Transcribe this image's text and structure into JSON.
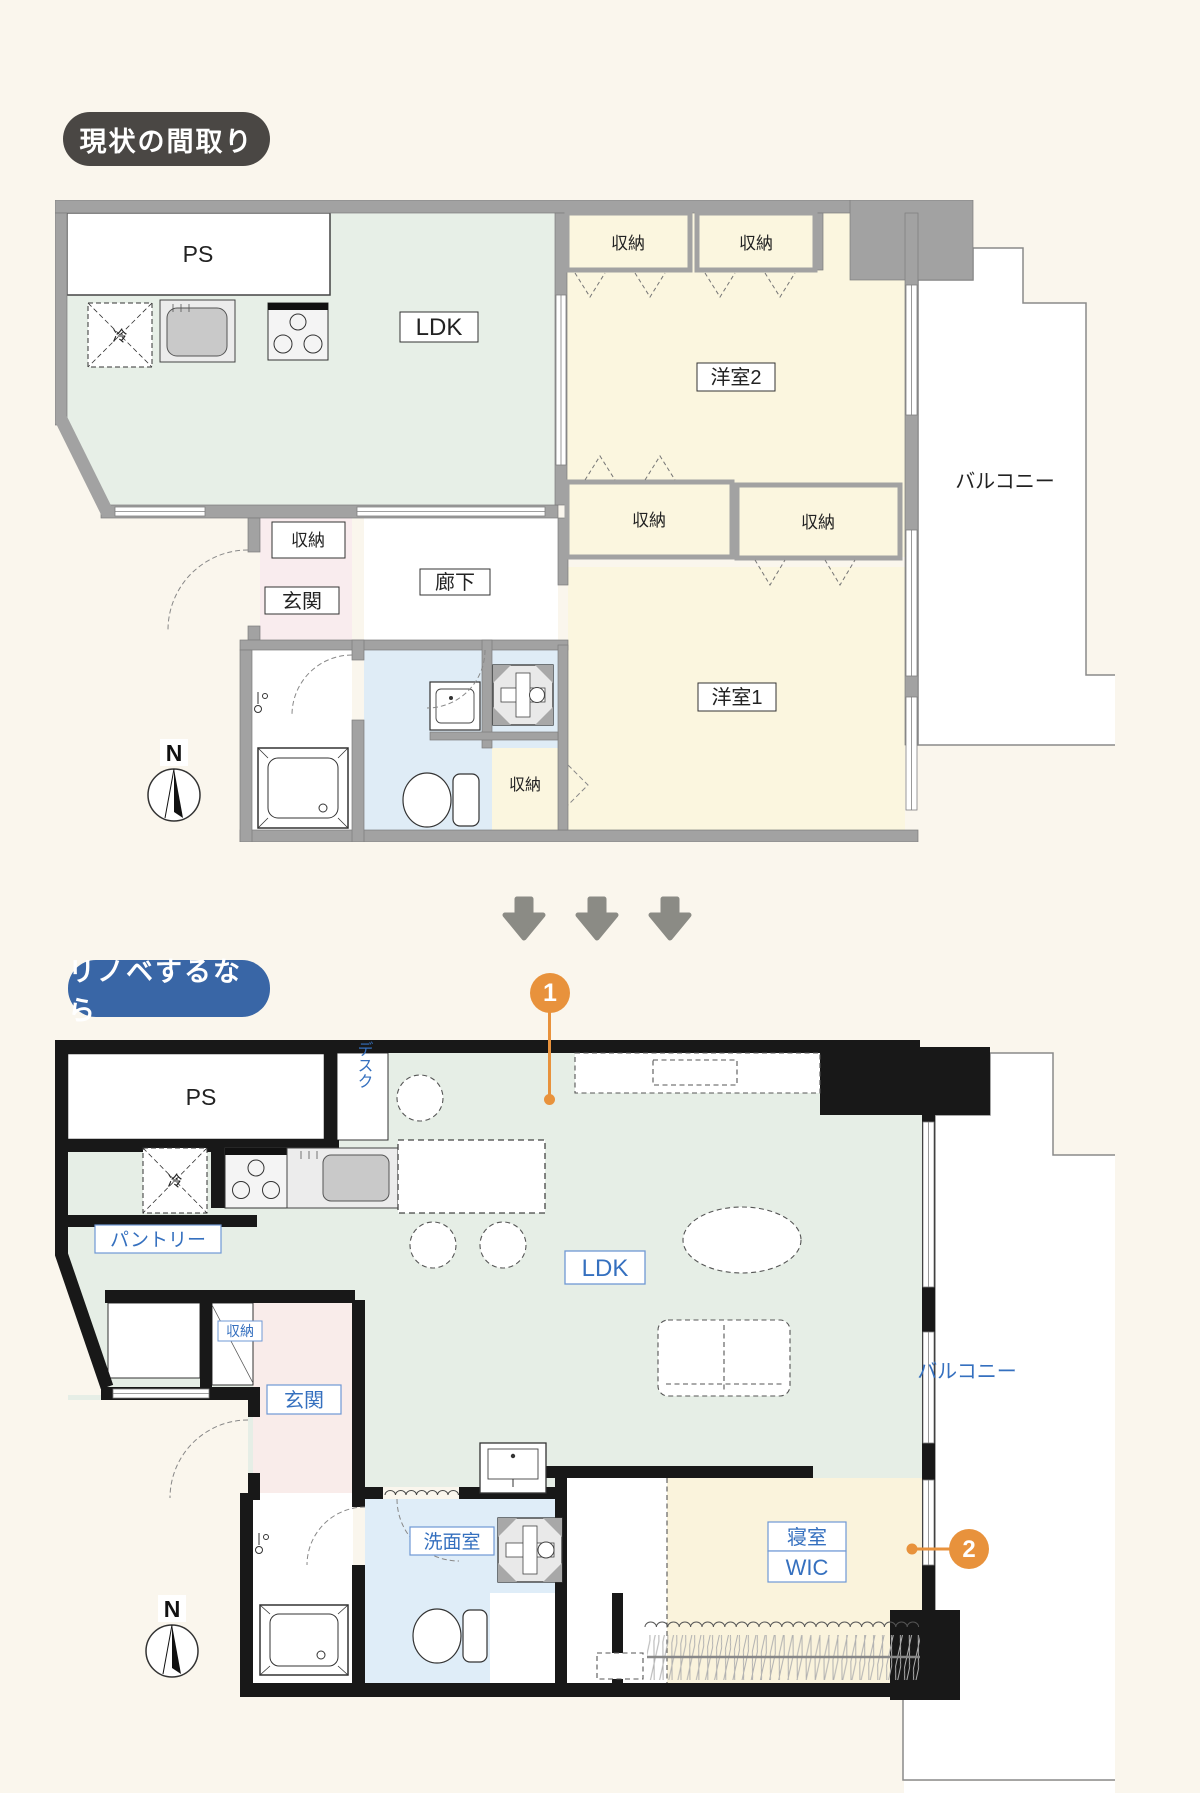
{
  "colors": {
    "page_bg": "#FAF6ED",
    "wall_gray": "#A2A2A2",
    "wall_black": "#181818",
    "room_green": "#E7EFE7",
    "room_cream": "#FBF6DF",
    "room_pink": "#F9ECEE",
    "room_blue": "#DFECF6",
    "accent_orange": "#E8923C",
    "badge_gray_bg": "#4A4744",
    "badge_blue_bg": "#3966A6",
    "label_blue": "#3570BF",
    "arrow_gray": "#8B8B85"
  },
  "current": {
    "badge": "現状の間取り",
    "labels": {
      "ps": "PS",
      "fridge": "冷",
      "ldk": "LDK",
      "closet": "収納",
      "room2": "洋室2",
      "room1": "洋室1",
      "genkan": "玄関",
      "hallway": "廊下",
      "balcony": "バルコニー",
      "north": "N"
    }
  },
  "renovated": {
    "badge": "リノベするなら",
    "labels": {
      "ps": "PS",
      "desk": "デスク",
      "fridge": "冷",
      "pantry": "パントリー",
      "closet": "収納",
      "ldk": "LDK",
      "genkan": "玄関",
      "washroom": "洗面室",
      "bedroom": "寝室",
      "wic": "WIC",
      "balcony": "バルコニー",
      "north": "N"
    },
    "markers": {
      "one": "1",
      "two": "2"
    }
  }
}
